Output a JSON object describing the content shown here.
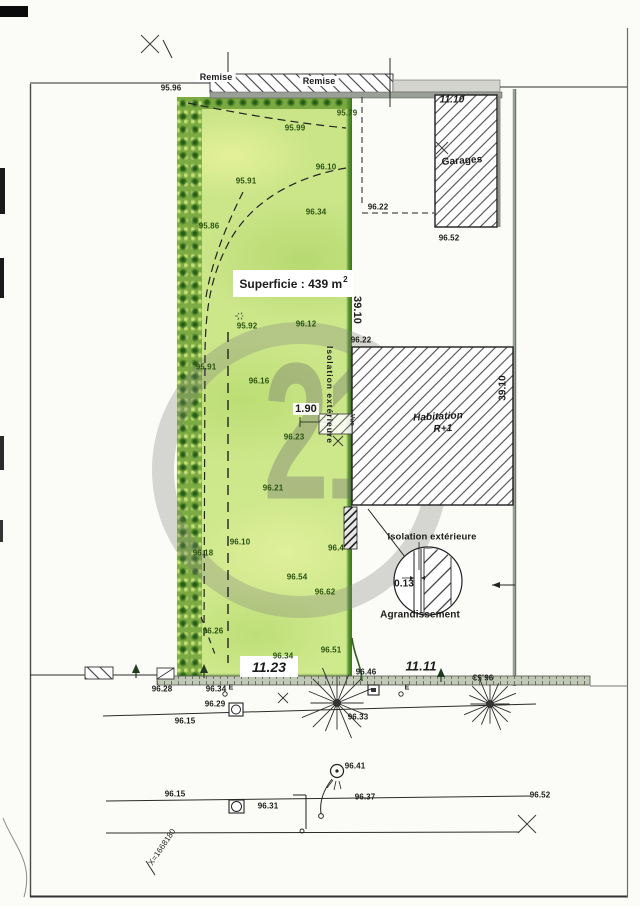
{
  "plan": {
    "watermark_digits": "21",
    "structures": {
      "remise_left": "Remise",
      "remise_right": "Remise",
      "garages": "Garages",
      "habitation": "Habitation",
      "habitation_level": "R+1"
    },
    "parcel": {
      "superficie_text": "Superficie : 439 m",
      "superficie_sup": "2",
      "frontage": "11.23"
    },
    "notes": {
      "isolation_boundary": "Isolation extérieure",
      "isolation_detail": "Isolation extérieure",
      "detail_caption": "Agrandissement",
      "vue": "Vue",
      "coord_x": "X=1668180",
      "electric": "E"
    },
    "dimensions": [
      {
        "t": "11.10",
        "x": 452,
        "y": 100,
        "cls": "d10 it"
      },
      {
        "t": "39.10",
        "x": 357,
        "y": 310,
        "r": 90,
        "cls": "d11"
      },
      {
        "t": "39.10",
        "x": 503,
        "y": 388,
        "r": -90,
        "cls": "d10"
      },
      {
        "t": "1.90",
        "x": 306,
        "y": 409,
        "cls": "d11 halo"
      },
      {
        "t": "0.13",
        "x": 404,
        "y": 584,
        "cls": "d10"
      },
      {
        "t": "11.11",
        "x": 421,
        "y": 666,
        "cls": "d13 it"
      }
    ],
    "spot_elevations": [
      {
        "t": "95.96",
        "x": 171,
        "y": 88
      },
      {
        "t": "95.79",
        "x": 347,
        "y": 113,
        "c": "g"
      },
      {
        "t": "95.99",
        "x": 295,
        "y": 128,
        "c": "g"
      },
      {
        "t": "96.10",
        "x": 326,
        "y": 167,
        "c": "g"
      },
      {
        "t": "95.91",
        "x": 246,
        "y": 181,
        "c": "g"
      },
      {
        "t": "96.34",
        "x": 316,
        "y": 212,
        "c": "g"
      },
      {
        "t": "95.86",
        "x": 209,
        "y": 226,
        "c": "g"
      },
      {
        "t": "96.22",
        "x": 378,
        "y": 207
      },
      {
        "t": "96.52",
        "x": 449,
        "y": 238
      },
      {
        "t": "95.92",
        "x": 247,
        "y": 326,
        "c": "g"
      },
      {
        "t": "96.12",
        "x": 306,
        "y": 324,
        "c": "g"
      },
      {
        "t": "96.22",
        "x": 361,
        "y": 340
      },
      {
        "t": "95.91",
        "x": 206,
        "y": 367,
        "c": "g"
      },
      {
        "t": "96.16",
        "x": 259,
        "y": 381,
        "c": "g"
      },
      {
        "t": "96.23",
        "x": 294,
        "y": 437,
        "c": "g"
      },
      {
        "t": "96.21",
        "x": 273,
        "y": 488,
        "c": "g"
      },
      {
        "t": "96.18",
        "x": 203,
        "y": 553,
        "c": "g"
      },
      {
        "t": "96.10",
        "x": 240,
        "y": 542,
        "c": "g"
      },
      {
        "t": "96.4",
        "x": 336,
        "y": 548,
        "c": "g"
      },
      {
        "t": "96.54",
        "x": 297,
        "y": 577,
        "c": "g"
      },
      {
        "t": "96.62",
        "x": 325,
        "y": 592,
        "c": "g"
      },
      {
        "t": "96.26",
        "x": 213,
        "y": 631,
        "c": "g"
      },
      {
        "t": "96.34",
        "x": 283,
        "y": 656,
        "c": "g"
      },
      {
        "t": "96.51",
        "x": 331,
        "y": 650,
        "c": "g"
      },
      {
        "t": "96.46",
        "x": 366,
        "y": 672
      },
      {
        "t": "96.53",
        "x": 483,
        "y": 677,
        "r": 180
      },
      {
        "t": "96.28",
        "x": 162,
        "y": 689
      },
      {
        "t": "96.34",
        "x": 216,
        "y": 689
      },
      {
        "t": "96.29",
        "x": 215,
        "y": 704
      },
      {
        "t": "96.15",
        "x": 185,
        "y": 721
      },
      {
        "t": "96.33",
        "x": 358,
        "y": 717
      },
      {
        "t": "96.15",
        "x": 175,
        "y": 794
      },
      {
        "t": "96.41",
        "x": 355,
        "y": 766
      },
      {
        "t": "96.31",
        "x": 268,
        "y": 806
      },
      {
        "t": "96.37",
        "x": 365,
        "y": 797
      },
      {
        "t": "96.52",
        "x": 540,
        "y": 795
      }
    ],
    "symbols": {
      "bursts": [
        {
          "x": 337,
          "y": 703,
          "r": 38
        },
        {
          "x": 490,
          "y": 704,
          "r": 28
        },
        {
          "x": 240,
          "y": 316,
          "r": 5
        }
      ],
      "trees": [
        {
          "x": 136,
          "y": 671
        },
        {
          "x": 204,
          "y": 671
        },
        {
          "x": 441,
          "y": 675
        }
      ],
      "crosses": [
        {
          "x": 150,
          "y": 44,
          "s": 9
        },
        {
          "x": 442,
          "y": 148,
          "s": 6
        },
        {
          "x": 283,
          "y": 698,
          "s": 5
        },
        {
          "x": 527,
          "y": 824,
          "s": 9
        },
        {
          "x": 338,
          "y": 441,
          "s": 5
        }
      ]
    }
  }
}
